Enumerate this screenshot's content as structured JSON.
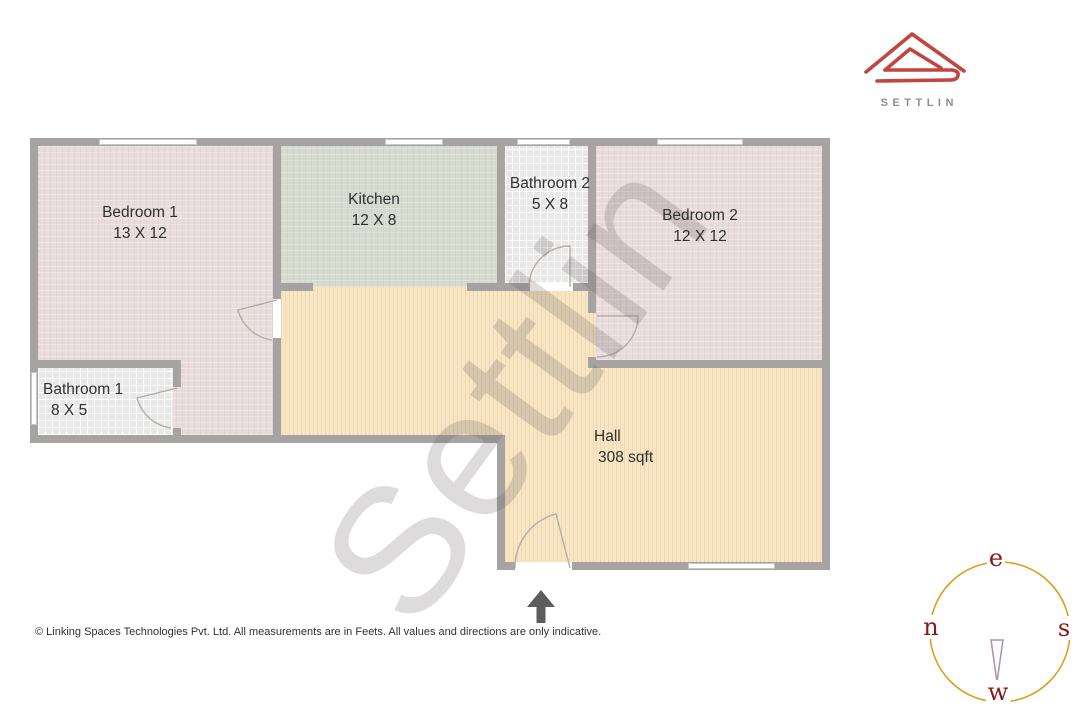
{
  "brand": {
    "name": "SETTLIN"
  },
  "watermark": {
    "text": "Settlin"
  },
  "plan": {
    "rooms": {
      "bedroom1": {
        "name": "Bedroom 1",
        "dims": "13 X 12"
      },
      "kitchen": {
        "name": "Kitchen",
        "dims": "12 X 8"
      },
      "bathroom2": {
        "name": "Bathroom 2",
        "dims": "5 X 8"
      },
      "bedroom2": {
        "name": "Bedroom 2",
        "dims": "12 X 12"
      },
      "bathroom1": {
        "name": "Bathroom 1",
        "dims": "8 X 5"
      },
      "hall": {
        "name": "Hall",
        "area": "308 sqft"
      }
    }
  },
  "compass": {
    "top": "e",
    "left": "n",
    "right": "s",
    "bottom": "w"
  },
  "footer": {
    "disclaimer": "© Linking Spaces Technologies Pvt. Ltd. All measurements are in Feets. All values and directions are only indicative."
  },
  "colors": {
    "bedroom": "#e9dcdc",
    "kitchen": "#d6dacf",
    "bathroom": "#e8e8e8",
    "hall": "#f7e5c5",
    "wall": "#a7a3a3",
    "logo_red": "#c2463f",
    "compass_ring": "#d8a01d",
    "compass_letter": "#8c1717"
  }
}
